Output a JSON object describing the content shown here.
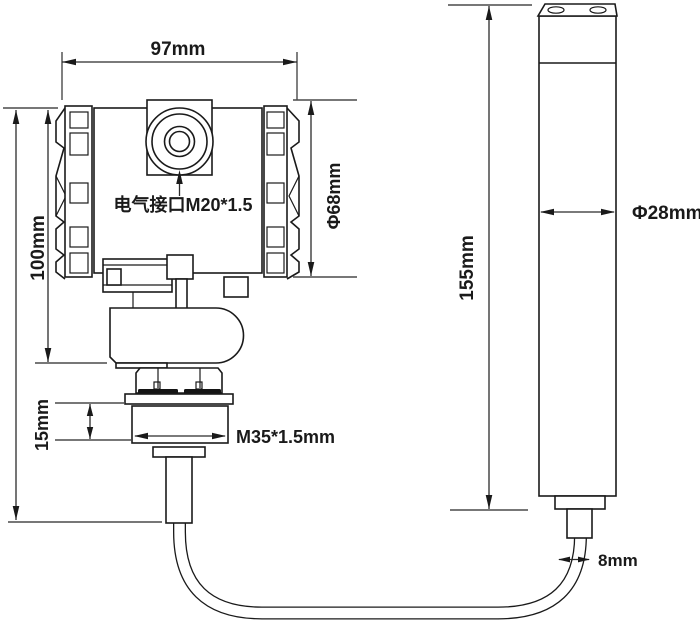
{
  "drawing": {
    "description": "dimensional outline drawing of a flange-mounted level transmitter with submersible probe",
    "colors": {
      "background": "#ffffff",
      "outline": "#1a1a1a",
      "dimension": "#2b2b2b"
    },
    "transmitter": {
      "width_dim": "97mm",
      "height_dim": "100mm",
      "body_diameter_dim": "Φ68mm",
      "electrical_port_note": "电气接口M20*1.5",
      "lock_nut_height_dim": "15mm",
      "thread_spec": "M35*1.5mm"
    },
    "probe": {
      "length_dim": "155mm",
      "diameter_dim": "Φ28mm",
      "cable_diameter_dim": "8mm"
    }
  }
}
